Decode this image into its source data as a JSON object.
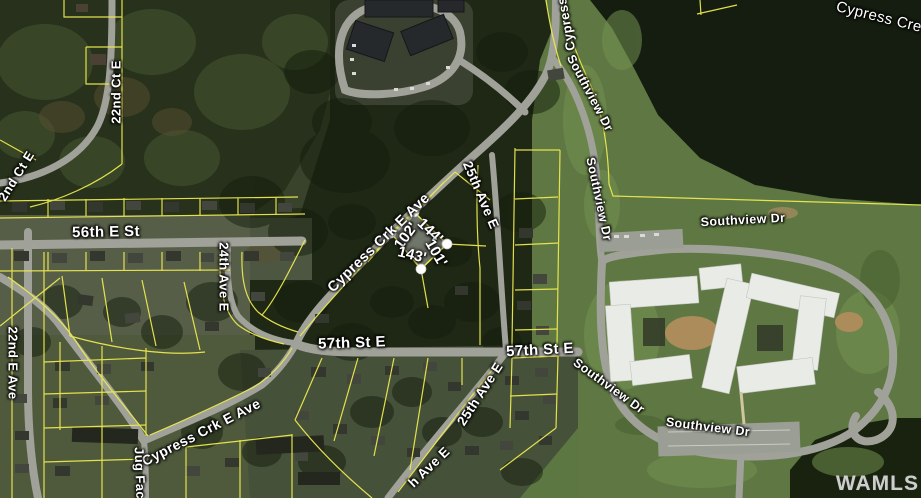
{
  "labels": [
    {
      "text": "22nd Ct E"
    },
    {
      "text": "2nd Ct E"
    },
    {
      "text": "56th E St"
    },
    {
      "text": "24th Ave E"
    },
    {
      "text": "22nd E Ave"
    },
    {
      "text": "Cypress Crk E Ave"
    },
    {
      "text": "Cypress Crk E Ave"
    },
    {
      "text": "Jug Fac"
    },
    {
      "text": "57th St E"
    },
    {
      "text": "57th St E"
    },
    {
      "text": "25th Ave E"
    },
    {
      "text": "25th Ave E"
    },
    {
      "text": "h Ave E"
    },
    {
      "text": "Cypress"
    },
    {
      "text": "Southview Dr"
    },
    {
      "text": "Southview Dr"
    },
    {
      "text": "Southview Dr"
    },
    {
      "text": "Southview Dr"
    },
    {
      "text": "Southview Dr"
    },
    {
      "text": "Cypress Cre"
    }
  ],
  "parcel": {
    "dimensions": [
      "102'",
      "144'",
      "143'",
      "101'"
    ],
    "corner_marker_count": 4
  },
  "watermark": "WAMLS",
  "colors": {
    "parcel_line": "#ece94f",
    "road": "#a0a29a",
    "label_text": "#ffffff",
    "parcel_fill": "rgba(235,235,235,0.4)",
    "forest": "#151d10",
    "field": "#5f7843"
  }
}
